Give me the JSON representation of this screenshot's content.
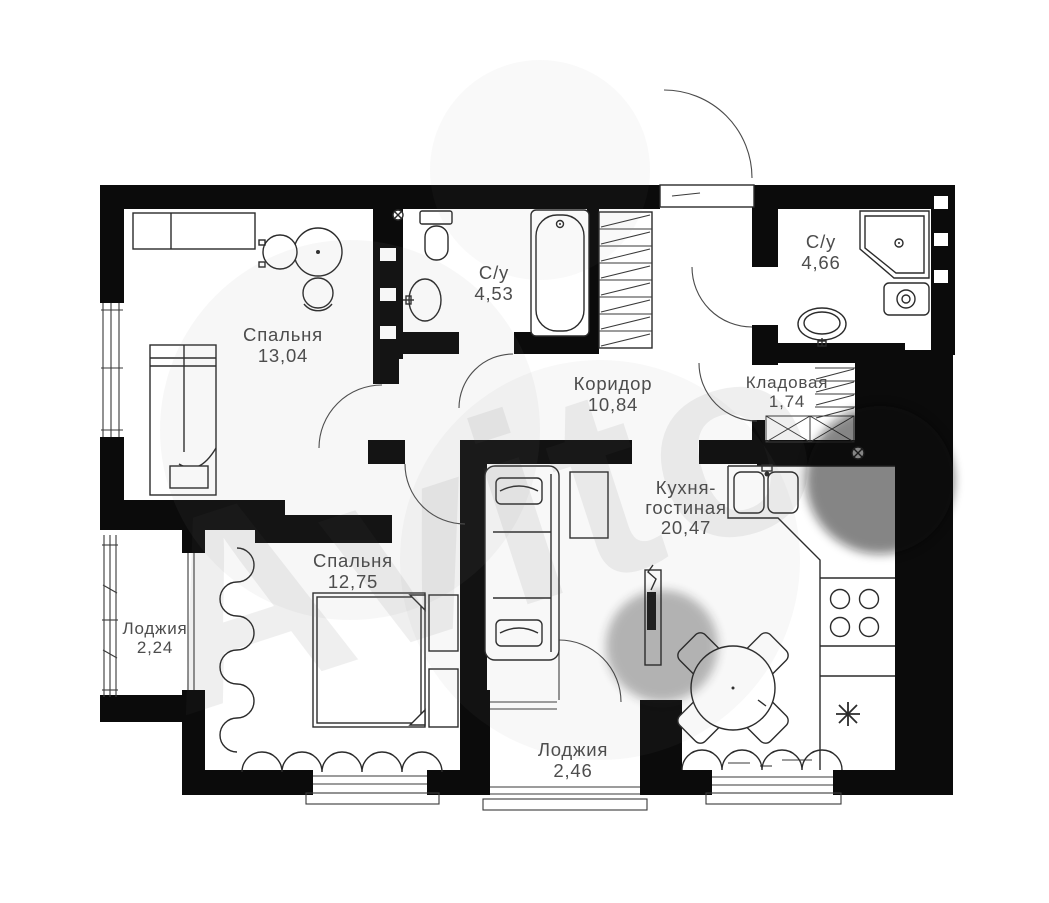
{
  "floorplan": {
    "watermark": "Avito",
    "colors": {
      "wall": "#0b0b0b",
      "line": "#2b2b2b",
      "label": "#4d4d4d",
      "background": "#ffffff"
    },
    "rooms": [
      {
        "name": "Спальня",
        "area": "13,04"
      },
      {
        "name": "С/у",
        "area": "4,53"
      },
      {
        "name": "С/у",
        "area": "4,66"
      },
      {
        "name": "Коридор",
        "area": "10,84"
      },
      {
        "name": "Кладовая",
        "area": "1,74"
      },
      {
        "name": "Кухня-",
        "name2": "гостиная",
        "area": "20,47"
      },
      {
        "name": "Спальня",
        "area": "12,75"
      },
      {
        "name": "Лоджия",
        "area": "2,24"
      },
      {
        "name": "Лоджия",
        "area": "2,46"
      }
    ]
  }
}
